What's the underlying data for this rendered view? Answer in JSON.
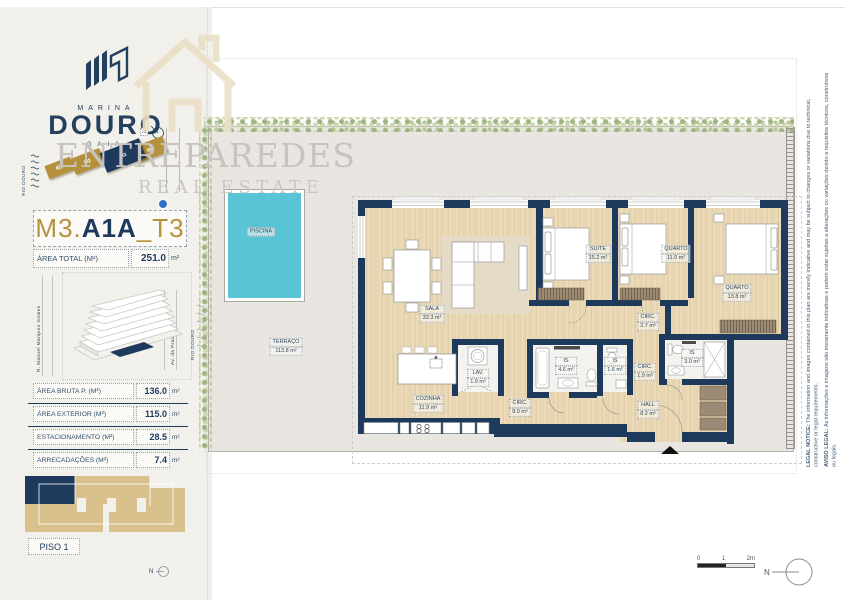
{
  "brand": {
    "top": "MARINA",
    "main": "DOURO",
    "sub": "GAIA"
  },
  "watermark": {
    "line1": "ENTREPAREDES",
    "line2": "REAL ESTATE"
  },
  "site_map": {
    "river": "RIO DOURO",
    "blocks": [
      {
        "label": "M1"
      },
      {
        "label": "M2"
      },
      {
        "label": "M3"
      },
      {
        "label": "M4"
      }
    ]
  },
  "unit": {
    "prefix": "M3.",
    "main": "A1A",
    "suffix": "_T3"
  },
  "area_total": {
    "label": "ÁREA TOTAL (M²)",
    "value": "251.0",
    "unit": "m²"
  },
  "location_map": {
    "street_left": "R. Manuel Marques Gomes",
    "street_right": "Av. da Praia",
    "river": "RIO DOURO"
  },
  "areas_table": {
    "rows": [
      {
        "label": "ÁREA BRUTA P. (M²)",
        "value": "136.0",
        "unit": "m²"
      },
      {
        "label": "ÁREA EXTERIOR (M²)",
        "value": "115.0",
        "unit": "m²"
      },
      {
        "label": "ESTACIONAMENTO (M²)",
        "value": "28.5",
        "unit": "m²"
      },
      {
        "label": "ARRECADAÇÕES (M²)",
        "value": "7.4",
        "unit": "m²"
      }
    ]
  },
  "key_plan": {
    "floor": "PISO 1"
  },
  "floor_plan": {
    "rooms": [
      {
        "name": "TERRAÇO",
        "area": "113.8 m²"
      },
      {
        "name": "PISCINA",
        "area": ""
      },
      {
        "name": "SALA",
        "area": "33.3 m²"
      },
      {
        "name": "COZINHA",
        "area": "11.9 m²"
      },
      {
        "name": "LAV.",
        "area": "1.9 m²"
      },
      {
        "name": "IS",
        "area": "4.6 m²"
      },
      {
        "name": "IS",
        "area": "1.6 m²"
      },
      {
        "name": "CIRC.",
        "area": "8.0 m²"
      },
      {
        "name": "SUITE",
        "area": "15.2 m²"
      },
      {
        "name": "QUARTO",
        "area": "11.0 m²"
      },
      {
        "name": "QUARTO",
        "area": "13.8 m²"
      },
      {
        "name": "CIRC.",
        "area": "2.7 m²"
      },
      {
        "name": "IS",
        "area": "3.0 m²"
      },
      {
        "name": "CIRC.",
        "area": "1.9 m²"
      },
      {
        "name": "HALL",
        "area": "8.2 m²"
      }
    ]
  },
  "legal": {
    "en_prefix": "LEGAL NOTICE:",
    "en_text": " The information and images contained in this plan are merely indicative and may be subject to changes or variations due to technical, constructive or legal requirements.",
    "pt_prefix": "AVISO LEGAL:",
    "pt_text": " As informações e imagens são meramente indicativas e podem estar sujeitas a alterações ou variações devido a requisitos técnicos, construtivos ou legais."
  },
  "scale_bar": {
    "t0": "0",
    "t1": "1",
    "t2": "2m"
  },
  "compass": {
    "label": "N"
  },
  "colors": {
    "navy": "#1d3a5c",
    "gold": "#b5913c",
    "pool": "#59c4d6",
    "wood": "#ecdbba",
    "tan": "#d8c18d"
  }
}
